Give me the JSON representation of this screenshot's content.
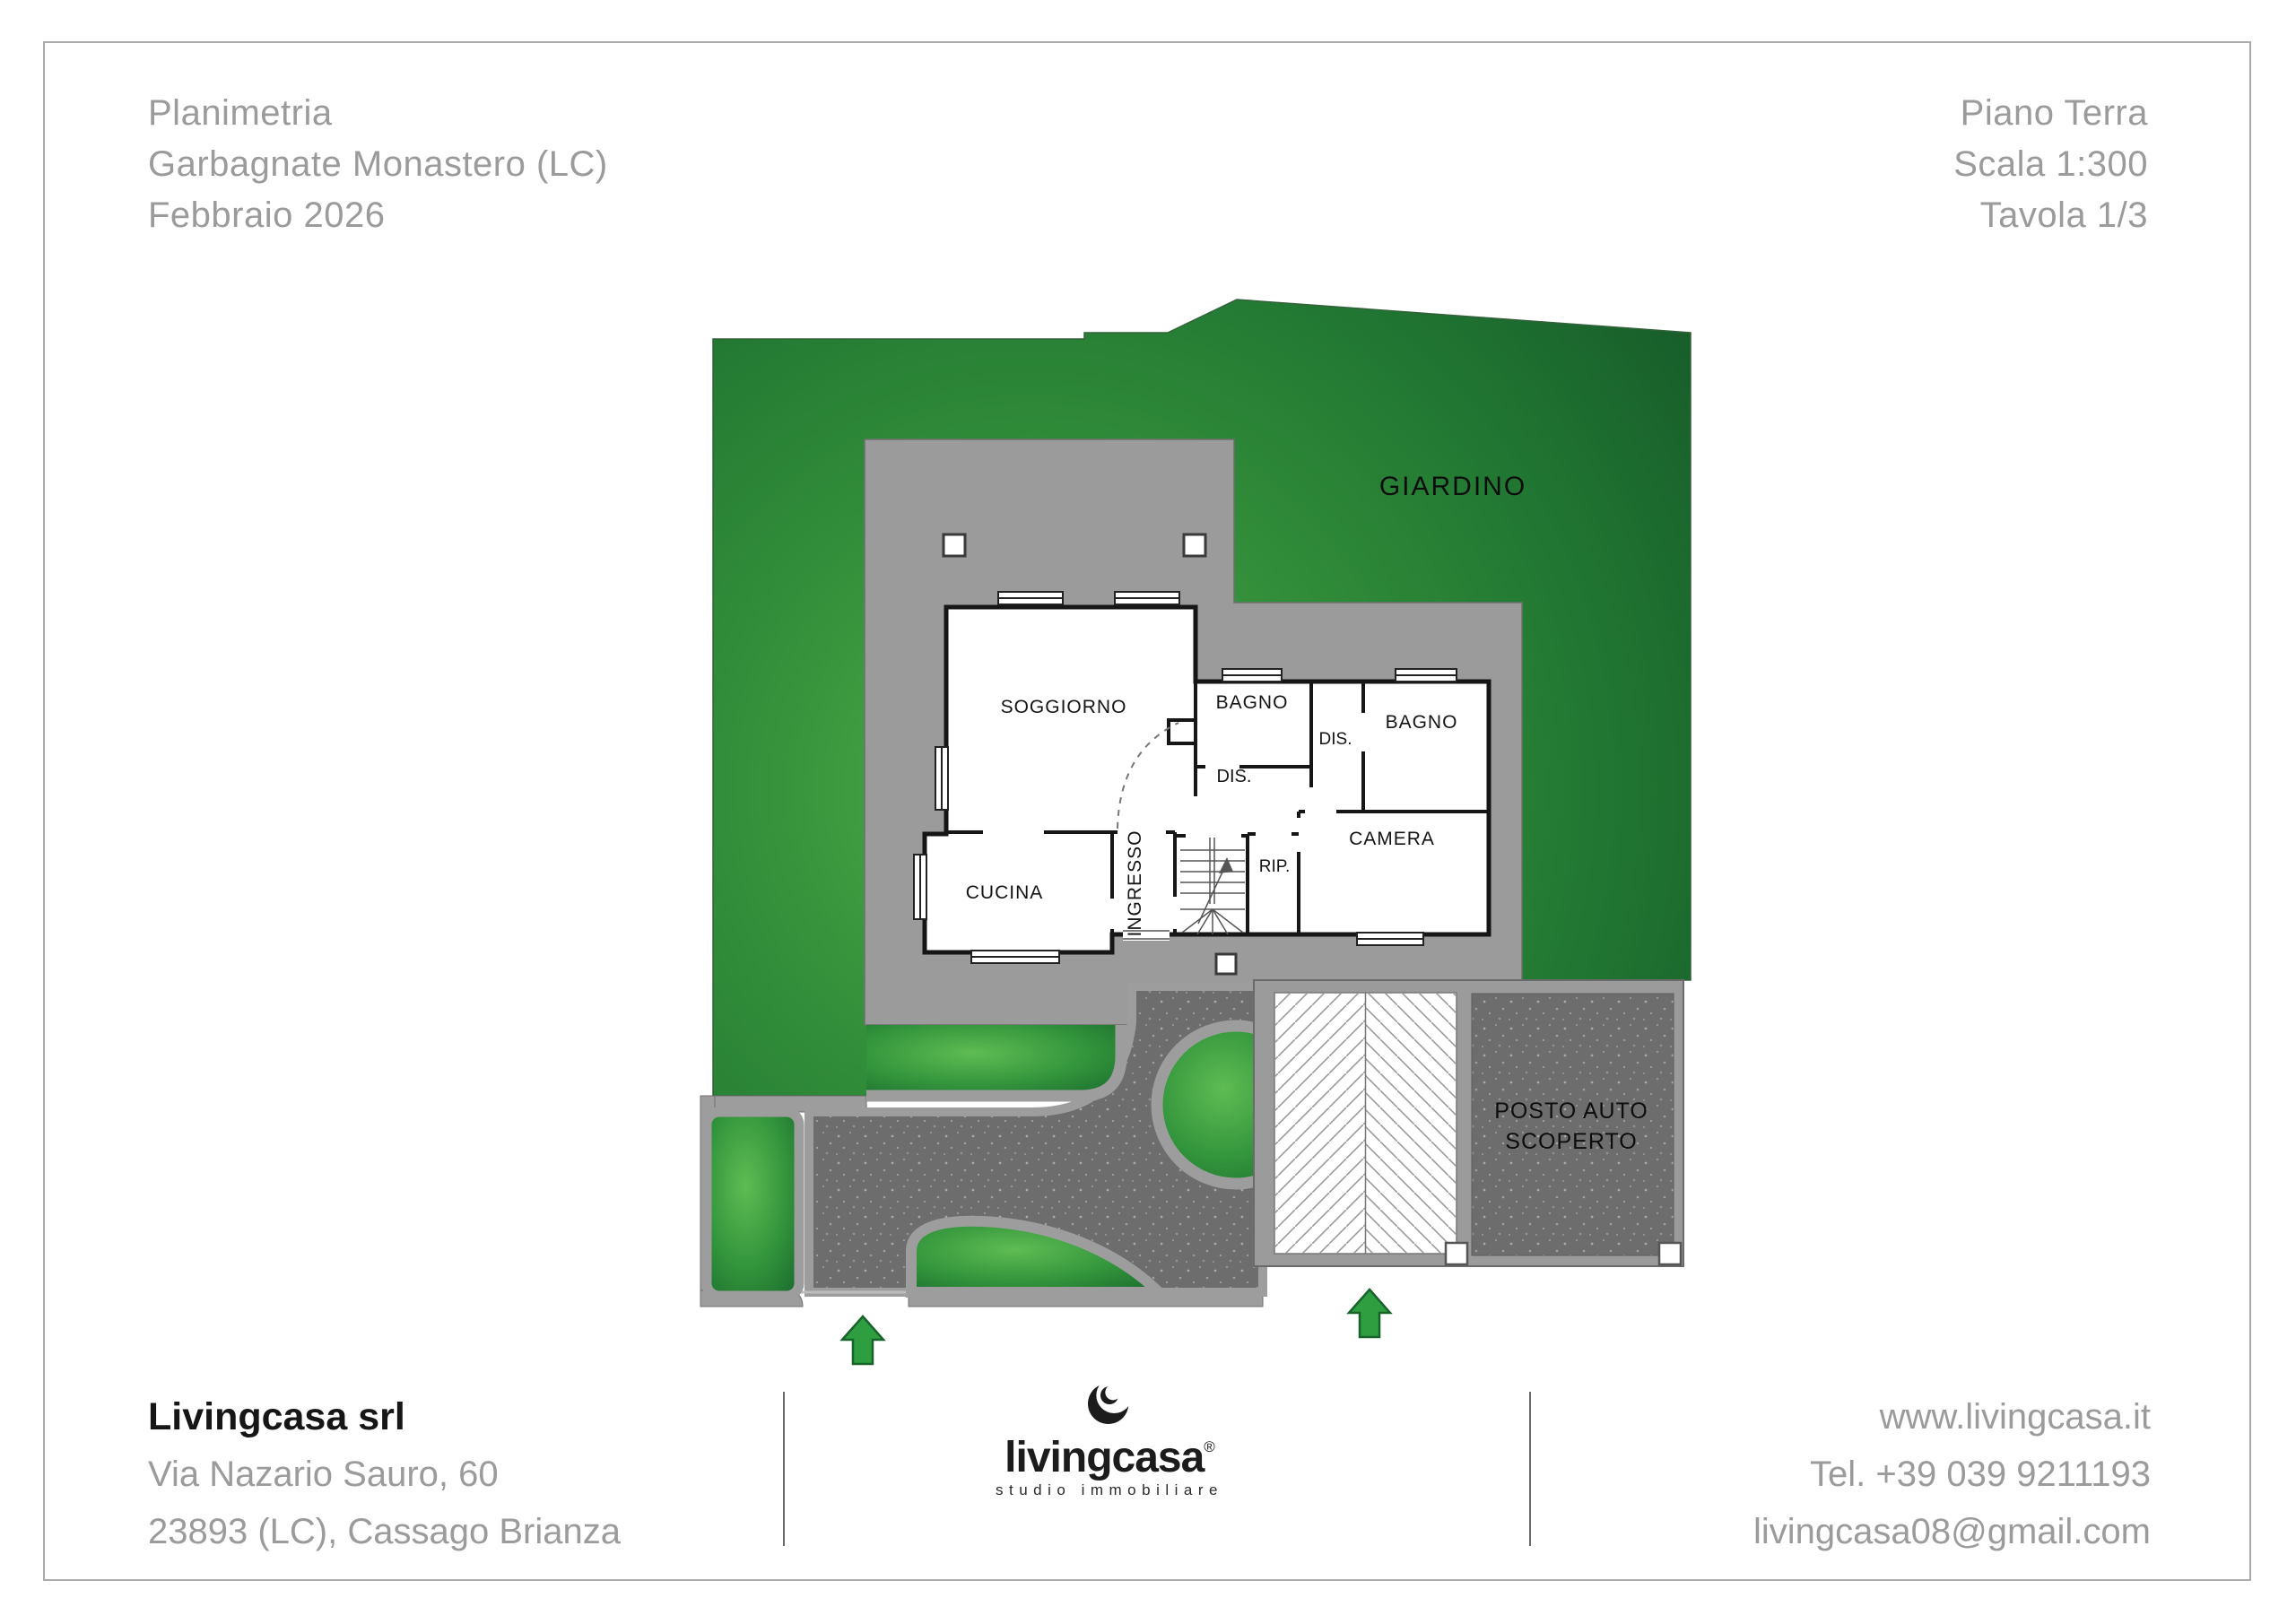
{
  "header": {
    "left": [
      "Planimetria",
      "Garbagnate Monastero (LC)",
      "Febbraio 2026"
    ],
    "right": [
      "Piano Terra",
      "Scala 1:300",
      "Tavola 1/3"
    ]
  },
  "plan": {
    "garden_label": "GIARDINO",
    "rooms": {
      "soggiorno": "SOGGIORNO",
      "bagno_top": "BAGNO",
      "dis_right": "DIS.",
      "bagno_right": "BAGNO",
      "dis_center": "DIS.",
      "ingresso": "INGRESSO",
      "cucina": "CUCINA",
      "rip": "RIP.",
      "camera": "CAMERA"
    },
    "parking_label_line1": "POSTO AUTO",
    "parking_label_line2": "SCOPERTO",
    "colors": {
      "garden_center": "#4fae47",
      "garden_edge": "#185f2b",
      "patio_gray": "#9b9b9b",
      "path_gray": "#6d6d6d",
      "wall_black": "#161616",
      "arrow_green": "#2f9e41"
    }
  },
  "footer": {
    "company": "Livingcasa srl",
    "address_line1": "Via Nazario Sauro, 60",
    "address_line2": "23893 (LC), Cassago Brianza",
    "logo_name": "livingcasa",
    "logo_registered": "®",
    "logo_tagline": "studio immobiliare",
    "website": "www.livingcasa.it",
    "phone": "Tel. +39 039 9211193",
    "email": "livingcasa08@gmail.com"
  }
}
